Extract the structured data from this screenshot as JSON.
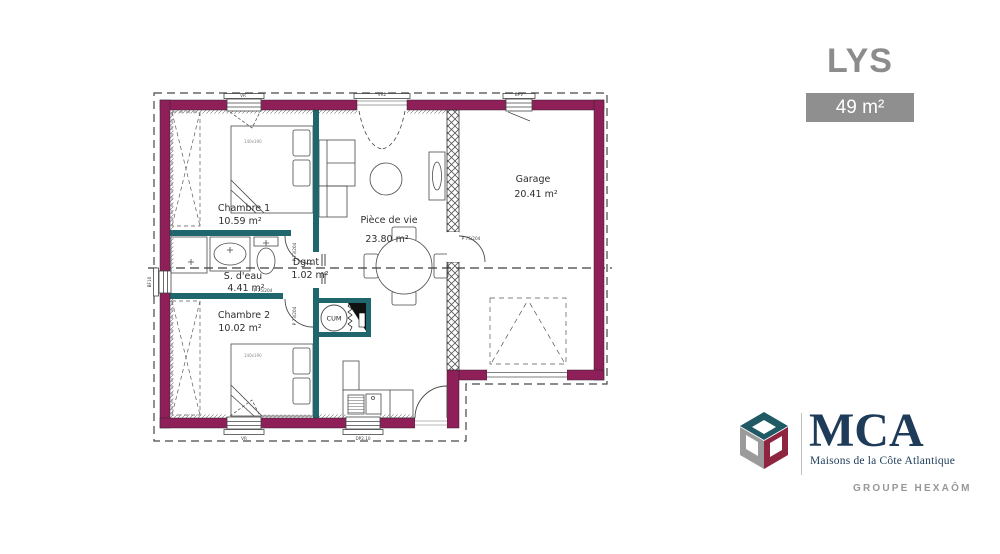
{
  "header": {
    "title": "LYS",
    "area_badge": "49 m²"
  },
  "plan": {
    "rooms": {
      "chambre1": {
        "name": "Chambre 1",
        "area": "10.59 m²"
      },
      "sdeau": {
        "name": "S. d'eau",
        "area": "4.41 m²"
      },
      "dgmt": {
        "name": "Dgmt",
        "area": "1.02 m²"
      },
      "chambre2": {
        "name": "Chambre 2",
        "area": "10.02 m²"
      },
      "piece_de_vie": {
        "name": "Pièce de vie",
        "area": "23.80 m²"
      },
      "garage": {
        "name": "Garage",
        "area": "20.41 m²"
      }
    },
    "equipment": {
      "water_heater": "CUM",
      "bed1_size": "140x190",
      "bed2_size": "140x190"
    },
    "window_tags": {
      "top_left": "VR",
      "top_center": "VR2",
      "top_right": "BPV",
      "left_side": "BF10",
      "bottom_left": "VR",
      "bottom_center": "DP2.10"
    },
    "door_tags": {
      "chambre1_door": "P 73/204",
      "sdeau_door": "P 75/204",
      "chambre2_door": "P 73/204",
      "garage_door": "P 75/204"
    },
    "colors": {
      "exterior_wall": "#8f1f58",
      "partition_wall": "#20666d"
    }
  },
  "logo": {
    "acronym": "MCA",
    "tagline": "Maisons de la Côte Atlantique",
    "group": "GROUPE HEXAÔM",
    "colors": {
      "navy": "#1e3c59",
      "gray": "#9b9b9b",
      "teal": "#1f5964",
      "red": "#8e2440"
    }
  }
}
